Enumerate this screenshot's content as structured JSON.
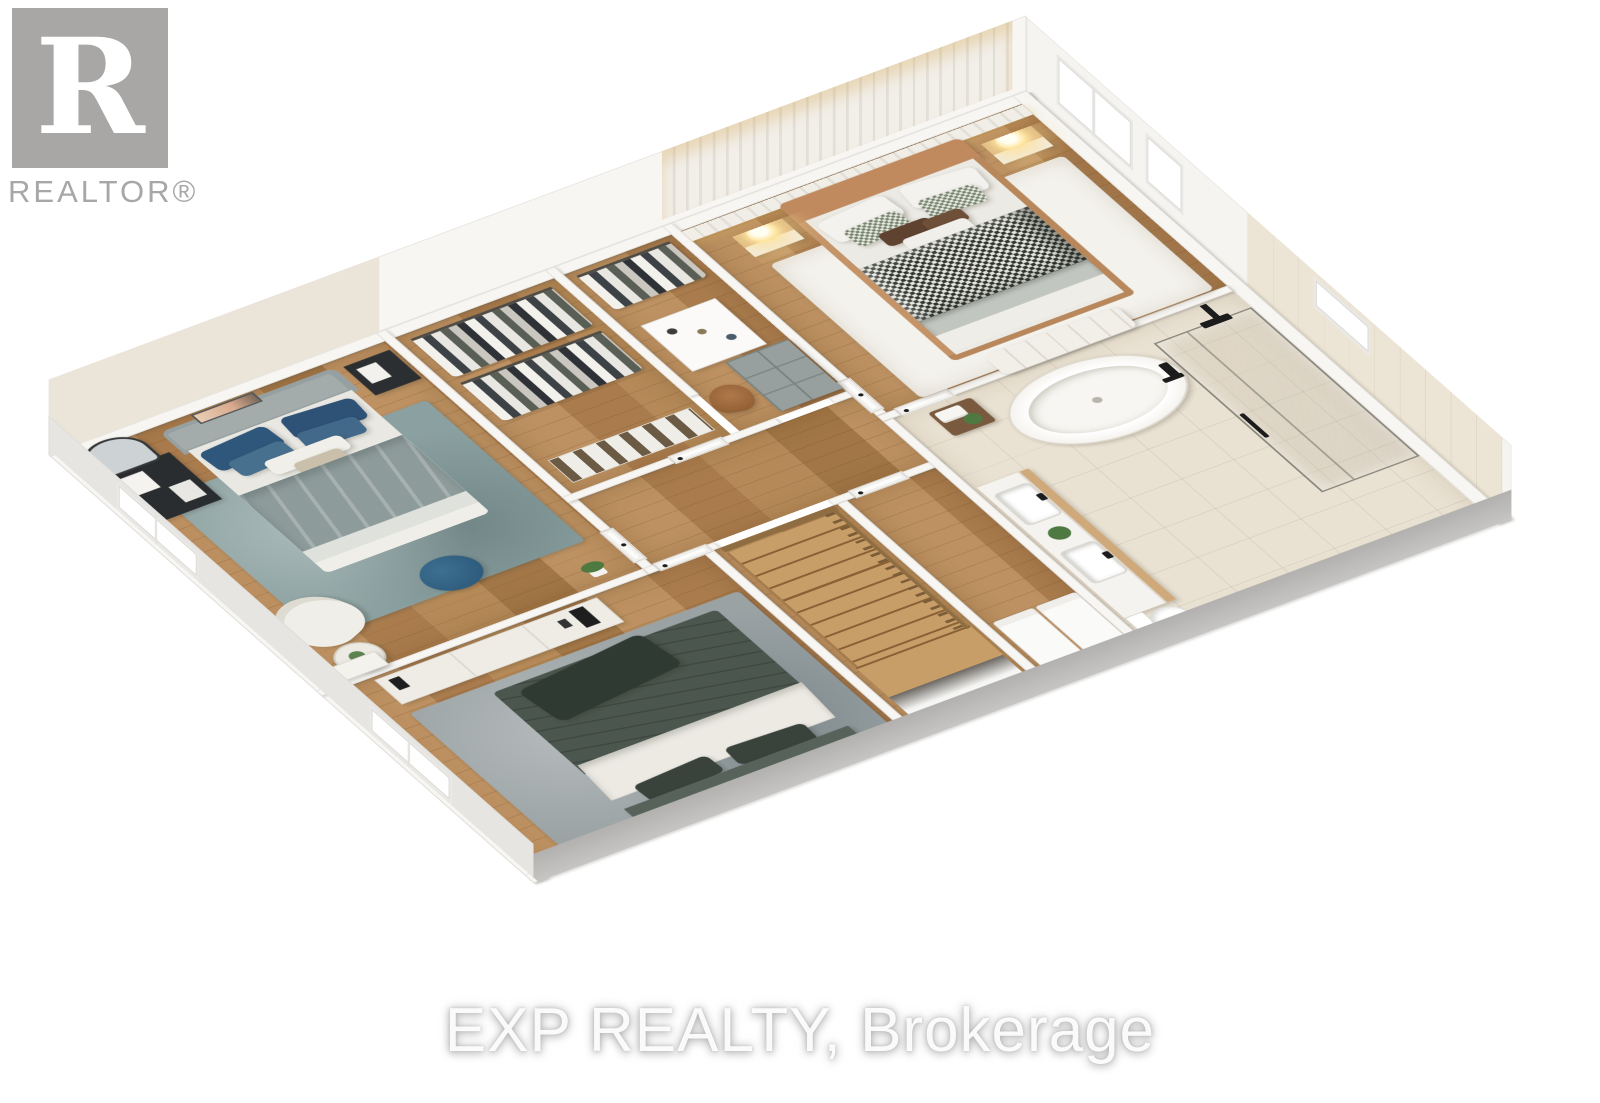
{
  "branding": {
    "realtor_logo": {
      "letter": "R",
      "label": "REALTOR®"
    },
    "watermark_text": "EXP REALTY, Brokerage"
  },
  "scene": {
    "type": "3d-dollhouse-floorplan",
    "view": "isometric-cutaway",
    "floor_level": "upper-floor",
    "background_color": "#ffffff",
    "rooms": [
      {
        "id": "primary-bedroom",
        "label": "Primary Bedroom",
        "furniture": [
          "king-bed-tan-frame",
          "checkered-duvet",
          "foot-bench",
          "nightstand-left",
          "nightstand-right",
          "glowing-lamp-left",
          "glowing-lamp-right",
          "cream-area-rug",
          "panel-accent-wall",
          "tall-window",
          "short-window"
        ]
      },
      {
        "id": "bedroom-2",
        "label": "Bedroom 2",
        "furniture": [
          "gray-upholstered-bed",
          "blue-pillows",
          "arched-floor-mirror",
          "black-dresser",
          "black-nightstand",
          "white-armchair",
          "round-side-table",
          "blue-pouf",
          "teal-area-rug",
          "wall-art",
          "plant",
          "corner-cabinet",
          "window"
        ]
      },
      {
        "id": "bedroom-3",
        "label": "Bedroom 3",
        "furniture": [
          "dark-green-bed",
          "white-sheet",
          "media-console",
          "speakers",
          "gray-area-rug",
          "window"
        ]
      },
      {
        "id": "walk-in-closet",
        "label": "Walk-in Closet",
        "furniture": [
          "hanging-rail-upper",
          "hanging-rail-lower",
          "shoe-shelf",
          "garment-rack",
          "island-dresser",
          "cube-shelf",
          "tan-accent-chair"
        ]
      },
      {
        "id": "bathroom",
        "label": "Primary Bathroom",
        "furniture": [
          "freestanding-oval-tub",
          "black-floor-faucet",
          "wood-stool-with-towels",
          "double-sink-vanity",
          "potted-plants",
          "glass-shower",
          "black-rain-shower-head",
          "toilet"
        ]
      },
      {
        "id": "laundry-room",
        "label": "Laundry / Utility Room",
        "furniture": [
          "appliance-left",
          "appliance-right"
        ]
      },
      {
        "id": "hallway",
        "label": "Hallway",
        "furniture": [
          "door-bedroom-2",
          "door-bedroom-3",
          "door-closet",
          "door-primary-bedroom",
          "door-bathroom",
          "door-laundry"
        ]
      },
      {
        "id": "staircase",
        "label": "Staircase",
        "furniture": [
          "wood-treads",
          "landing",
          "wood-baluster-railing",
          "stairwell-opening"
        ]
      }
    ],
    "palette": {
      "wood_floor": "#b3865a",
      "tile_floor": "#e9e1d2",
      "wall_fill": "#f7f6f3",
      "wall_cut_face": "#bdbcba",
      "rug_teal": "#8ba0a0",
      "rug_gray": "#9aa2a4",
      "rug_cream": "#f4f2ed",
      "pillow_blue": "#2e577b",
      "pouf_blue": "#2e5f80",
      "duvet_green": "#4b564e",
      "duvet_checker_dark": "#30342f",
      "headboard_tan": "#c08a5e",
      "nightstand_wood": "#cfa97a",
      "lamp_glow": "#ffe9a6",
      "fixture_black": "#1c1c1c",
      "logo_gray": "#a8a7a5"
    }
  }
}
